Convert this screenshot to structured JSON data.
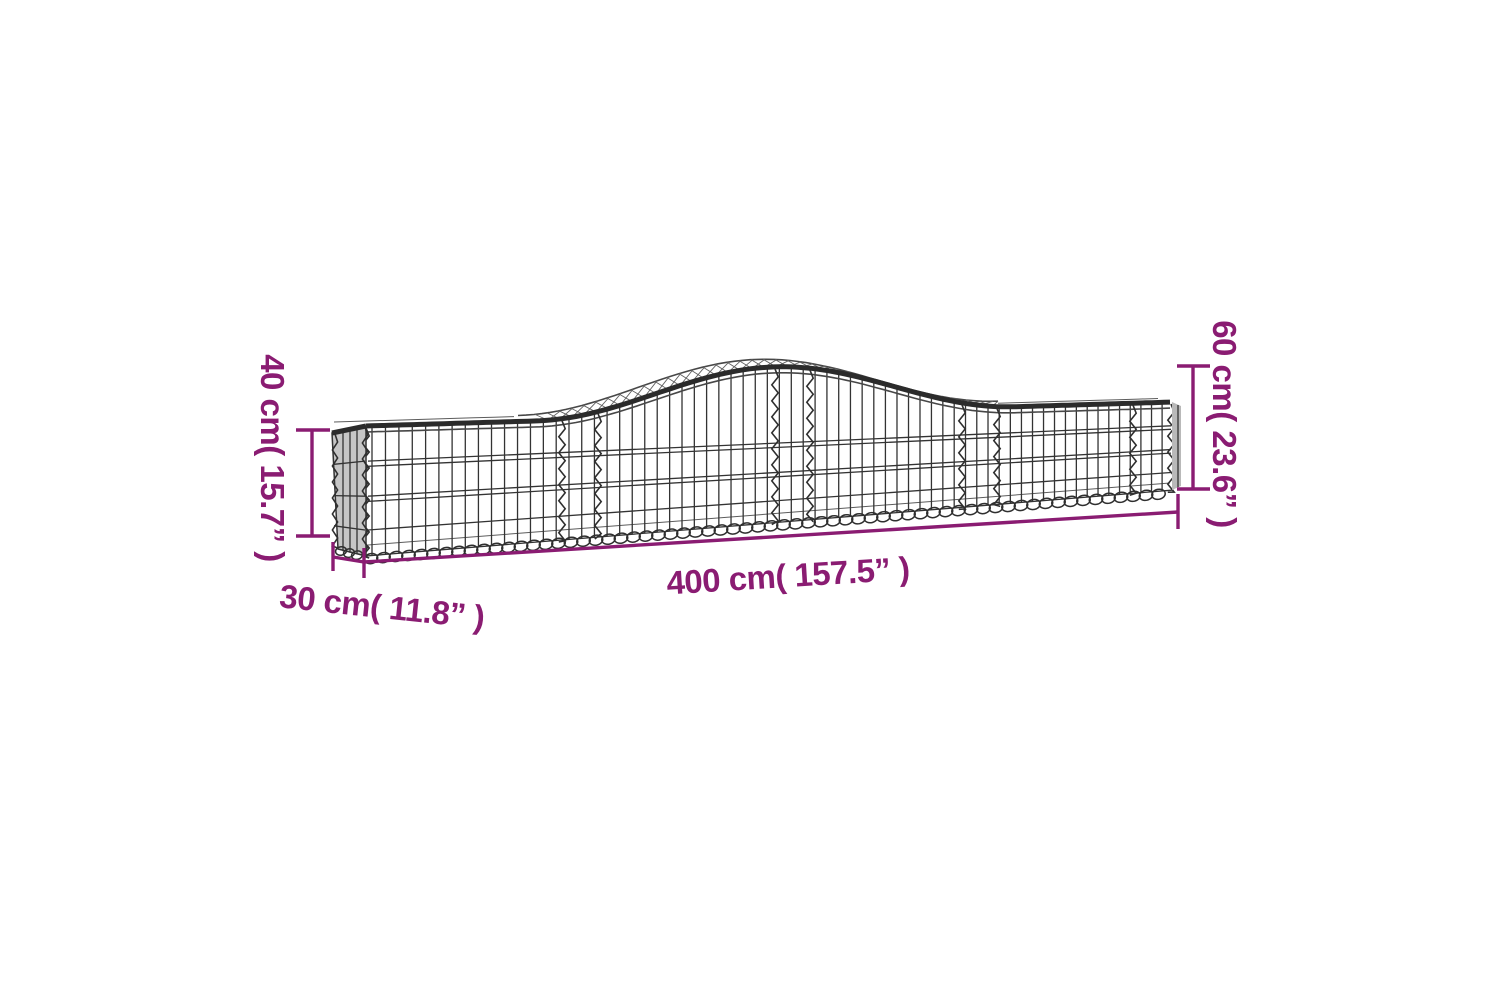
{
  "page": {
    "background": "#ffffff"
  },
  "accent_color": "#8a1c72",
  "illustration": {
    "type": "arched-gabion-basket-wireframe",
    "wire_color": "#333333",
    "panel_fill": "#c6c6c6"
  },
  "labels": {
    "height_left": "40 cm( 15.7” )",
    "height_right": "60 cm( 23.6” )",
    "length": "400 cm( 157.5” )",
    "depth": "30 cm( 11.8” )"
  },
  "measurements": {
    "end_height_cm": 40,
    "end_height_in": 15.7,
    "peak_height_cm": 60,
    "peak_height_in": 23.6,
    "length_cm": 400,
    "length_in": 157.5,
    "depth_cm": 30,
    "depth_in": 11.8
  }
}
